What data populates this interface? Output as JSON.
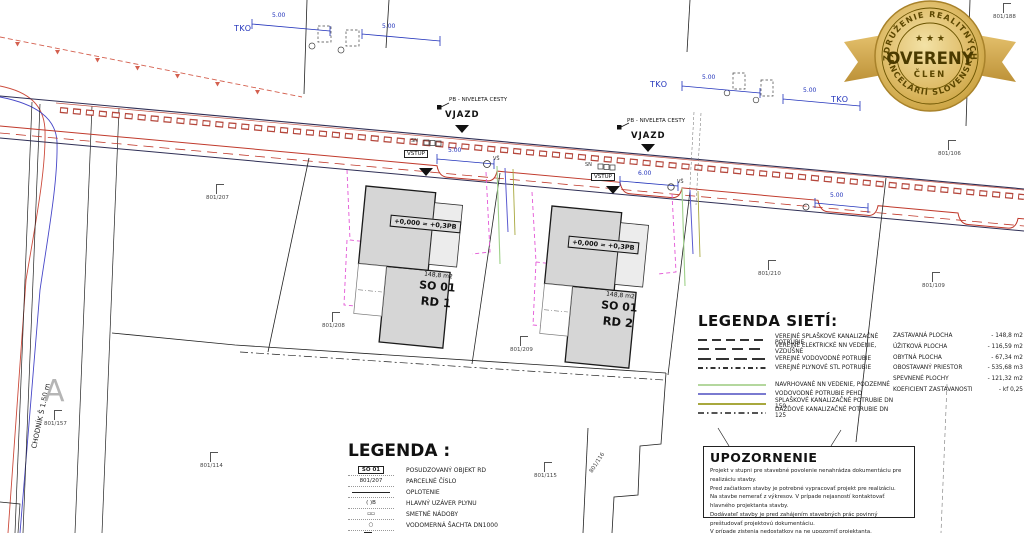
{
  "badge": {
    "arc_top": "ZDRUŽENIE REALITNÝCH",
    "arc_bottom": "KANCELÁRIÍ SLOVENSKA",
    "stars": "★ ★ ★",
    "title": "OVERENÝ",
    "subtitle": "ČLEN"
  },
  "road": {
    "tko": "TKO",
    "vjazd": "VJAZD",
    "vstup": "VSTUP",
    "pb_niveleta": "PB - NIVELETA CESTY",
    "sn": "SN",
    "vs": "VŠ",
    "sidewalk": "CHODNÍK Š 1.50 m",
    "north_mark": "A",
    "dims": {
      "d1": "5.00",
      "d2": "5.00",
      "d3": "5.00",
      "d4": "5.00",
      "d5": "5.00",
      "d6": "6.00",
      "d7": "5.00"
    }
  },
  "houses": [
    {
      "level": "+0,000 = +0,3PB",
      "area": "148,8 m2",
      "so": "SO 01",
      "rd": "RD 1"
    },
    {
      "level": "+0,000 = +0,3PB",
      "area": "148,8 m2",
      "so": "SO 01",
      "rd": "RD 2"
    }
  ],
  "parcels": {
    "p188": "801/188",
    "p106": "801/106",
    "p109": "801/109",
    "p210": "801/210",
    "p207": "801/207",
    "p208": "801/208",
    "p209": "801/209",
    "p157": "801/157",
    "p114": "801/114",
    "p115": "801/115",
    "p116": "801/116"
  },
  "legend_networks": {
    "title": "LEGENDA SIETÍ:",
    "items": [
      {
        "label": "VEREJNÉ SPLAŠKOVÉ KANALIZAČNÉ POTRUBIE"
      },
      {
        "label": "VEREJNÉ ELEKTRICKÉ NN VEDENIE, VZDUŠNÉ"
      },
      {
        "label": "VEREJNÉ VODOVODNÉ POTRUBIE"
      },
      {
        "label": "VEREJNÉ PLYNOVÉ STL POTRUBIE"
      },
      {
        "label": "NAVRHOVANÉ NN VEDENIE, PODZEMNÉ"
      },
      {
        "label": "VODOVODNÉ POTRUBIE PEHD"
      },
      {
        "label": "SPLAŠKOVÉ KANALIZAČNÉ POTRUBIE DN 150"
      },
      {
        "label": "DAŽĎOVÉ KANALIZAČNÉ POTRUBIE DN 125"
      }
    ]
  },
  "areas": {
    "rows": [
      {
        "label": "ZASTAVANÁ PLOCHA",
        "value": "- 148,8 m2"
      },
      {
        "label": "ÚŽITKOVÁ PLOCHA",
        "value": "- 116,59 m2"
      },
      {
        "label": "OBYTNÁ PLOCHA",
        "value": "- 67,34 m2"
      },
      {
        "label": "OBOSTAVANÝ PRIESTOR",
        "value": "- 535,68 m3"
      },
      {
        "label": "SPEVNENÉ PLOCHY",
        "value": "- 121,32 m2"
      },
      {
        "label": "KOEFICIENT ZASTAVANOSTI",
        "value": "- kf 0,25"
      }
    ]
  },
  "legend": {
    "title": "LEGENDA :",
    "items": [
      {
        "symbol": "SO 01",
        "label": "POSUDZOVANÝ OBJEKT RD"
      },
      {
        "symbol": "801/207",
        "label": "PARCELNÉ ČÍSLO"
      },
      {
        "symbol": "",
        "label": "OPLOTENIE"
      },
      {
        "symbol": "( )B",
        "label": "HLAVNÝ UZÁVER PLYNU"
      },
      {
        "symbol": "▫▫",
        "label": "SMETNÉ NÁDOBY"
      },
      {
        "symbol": "○",
        "label": "VODOMERNÁ ŠACHTA DN1000"
      },
      {
        "symbol": "E",
        "label": "ELEKTROMER"
      }
    ]
  },
  "notice": {
    "title": "UPOZORNENIE",
    "lines": [
      "Projekt v stupni pre stavebné povolenie nenahrádza dokumentáciu pre realizáciu stavby.",
      "Pred začiatkom stavby je potrebné vypracovať projekt pre realizáciu.",
      "Na stavbe nemerať z výkresov. V prípade nejasností kontaktovať hlavného projektanta stavby.",
      "Dodávateľ stavby je pred zahájením stavebných prác povinný preštudovať projektovú dokumentáciu.",
      "V prípade zistenia nedostatkov na ne upozorniť projektanta.",
      "Počas realizovania stavby je potrebné dodržiavať platné vyhlášky a STN."
    ]
  }
}
